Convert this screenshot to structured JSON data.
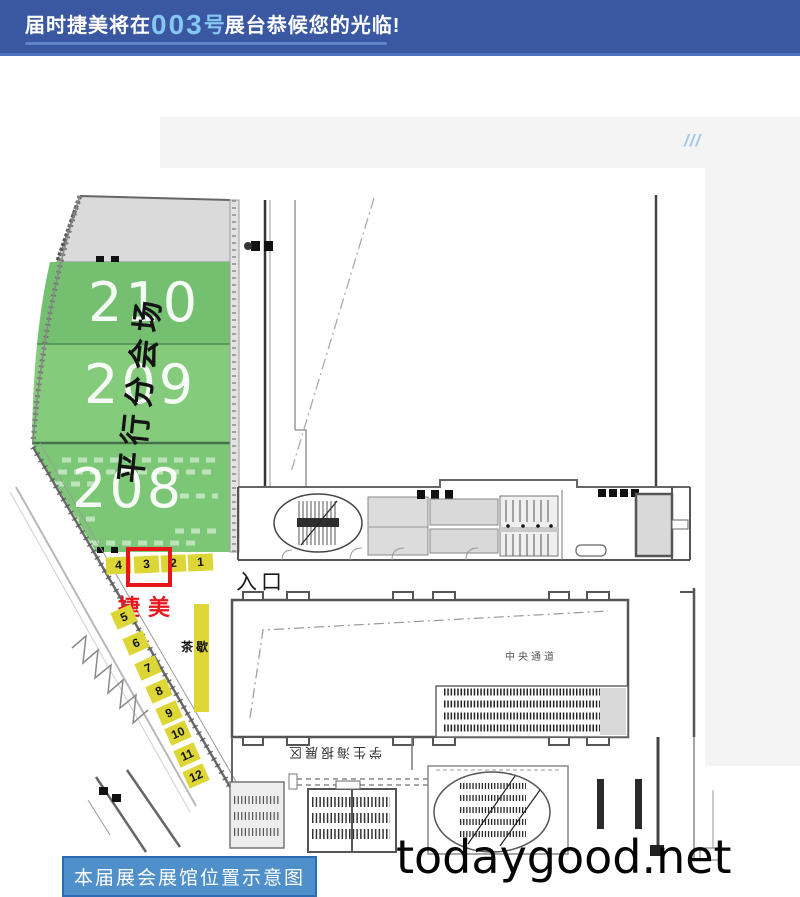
{
  "header": {
    "prefix": "届时捷美将在",
    "booth_no": "003",
    "booth_no_unit": "号",
    "suffix": "展台恭候您的光临!"
  },
  "decor_slashes": "///",
  "floorplan": {
    "halls": [
      {
        "number": "210"
      },
      {
        "number": "209"
      },
      {
        "number": "208"
      }
    ],
    "parallel_session_label": "平行分会场",
    "front_booths": [
      "4",
      "3",
      "2",
      "1"
    ],
    "side_booths": [
      "5",
      "6",
      "7",
      "8",
      "9",
      "10",
      "11",
      "12"
    ],
    "company_name": "捷美",
    "entrance_label": "入口",
    "tea_break_label": "茶歇",
    "central_corridor_label": "中央通道",
    "registration_area_label": "学生海报展区"
  },
  "watermark": "todaygood.net",
  "caption_button": "本届展会展馆位置示意图",
  "colors": {
    "header_bg": "#3a57a2",
    "header_highlight": "#85c6f2",
    "hall_green": "#7bc775",
    "booth_yellow": "#ddd637",
    "marker_red": "#e8151d",
    "button_blue": "#4f8fca"
  }
}
